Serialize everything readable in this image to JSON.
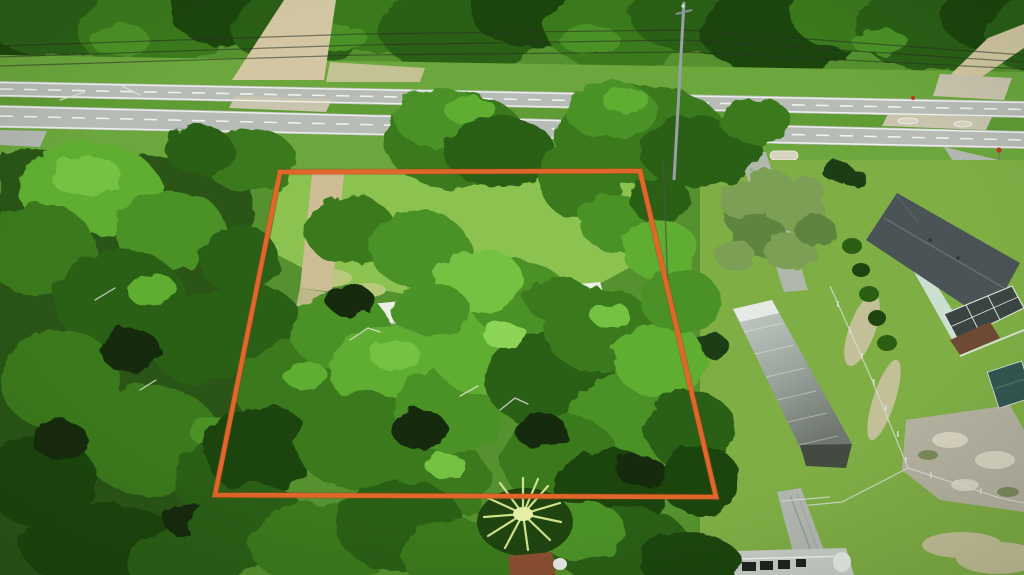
{
  "meta": {
    "type": "aerial-drone-photograph",
    "subject": "Aerial view of a tree-covered vacant lot outlined with an orange property boundary, located beside a divided highway with dirt-road intersections, a neighboring house with screened lanai, a long metal-roofed outbuilding, chain-link fencing and a palm tree",
    "width_px": 1024,
    "height_px": 575
  },
  "boundary": {
    "name": "property-boundary",
    "points": "280,172 640,171 716,497 215,495",
    "color": "#e0662b",
    "shadow_color": "#a33f12",
    "stroke_width": "4.6"
  },
  "palette": {
    "boundary": "#e0662b",
    "boundary_shadow": "#a33f12",
    "base_green": "#55912e",
    "forest_base": "#295417",
    "canopy_shadow": "#122b07",
    "canopy_deep": "#1f4410",
    "canopy_dark": "#2c5e14",
    "canopy_mid": "#3a7a1d",
    "canopy_green": "#4c9227",
    "canopy_light": "#5fae33",
    "canopy_bright": "#74c243",
    "canopy_highlight": "#8cd455",
    "olive": "#7b9e54",
    "olive_dark": "#5f8440",
    "hedge": "#1e3c13",
    "verge_grass": "#6ba73c",
    "median_grass": "#5f9c33",
    "clearing_grass": "#8cc24f",
    "dry_grass": "#b9c97c",
    "yard_grass": "#7fae45",
    "asphalt": "#b7bcb7",
    "lane_white": "#f2f4f0",
    "dirt_tan": "#d2c7a2",
    "crossover_pale": "#c9c4ae",
    "driveway_tan": "#cdbd95",
    "road_gray": "#b2b8b1",
    "mobile_home_white": "#eceee8",
    "shed_gray": "#b6beba",
    "trailer_dark": "#3f4f42",
    "metal_roof_light": "#c9d0ca",
    "metal_roof_mid": "#9aa39c",
    "metal_roof_dark": "#434a42",
    "fence_silver": "#d7dcd4",
    "sand": "#cbc3a1",
    "pavement_worn": "#b4b1a0",
    "pavement_light": "#d7d3c0",
    "house_roof": "#4a5356",
    "house_ridge": "#6a7477",
    "lanai_dark": "#3a4440",
    "lanai_frame": "#dfe5e2",
    "wall_teal": "#cfe2d8",
    "deck_brown": "#6e4a33",
    "teal_shed": "#335651",
    "bottom_roof": "#c9cdc8",
    "window_dark": "#1d2420",
    "palm_frond": "#cfe289",
    "palm_center": "#e4efa5",
    "rust_roof": "#8a4f31",
    "snag_white": "#dde4d4",
    "powerline": "#273123",
    "pole_gray": "#98a2a4",
    "sign_red": "#c03325"
  },
  "features": {
    "outlined_lot": "vacant wooded lot with orange boundary overlay",
    "highway": "divided two-carriageway highway with grass median",
    "north_dirt_road": "dirt road meeting highway at upper left",
    "northeast_dirt_road": "dirt road meeting highway at upper right",
    "interior_driveway": "dirt driveway entering lot from highway",
    "mobile_home": "white mobile-home roof hidden in trees",
    "storage_building": "long metal-roofed outbuilding east of lot",
    "neighbor_house": "house with dark shingle roof and screened pool lanai",
    "chain_link_fence": "chain-link fence along east yard",
    "palm_tree": "palm tree at bottom center",
    "utility_pole": "utility pole with overhead power lines"
  }
}
